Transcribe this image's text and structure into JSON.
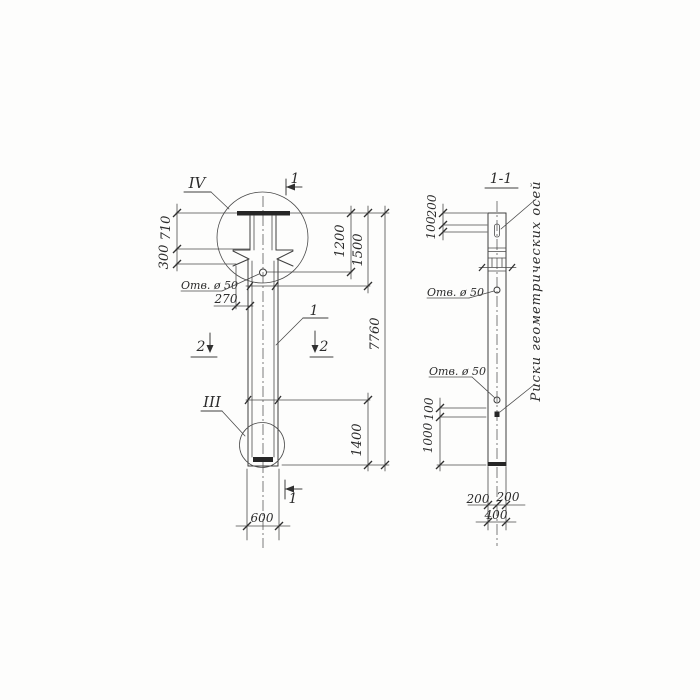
{
  "drawing": {
    "left_view": {
      "detail_circle_top_label": "IV",
      "detail_circle_bottom_label": "III",
      "section_cut_top_label": "1",
      "section_cut_bottom_label": "1",
      "section_cut_left_label": "2",
      "section_cut_right_label": "2",
      "position_label": "1",
      "hole_label": "Отв. ø 50",
      "dim_710": "710",
      "dim_300": "300",
      "dim_270": "270",
      "dim_1200": "1200",
      "dim_1500": "1500",
      "dim_7760": "7760",
      "dim_1400": "1400",
      "dim_600": "600"
    },
    "section_view": {
      "title": "1-1",
      "dim_200_top": "200",
      "dim_100_top": "100",
      "hole_label_upper": "Отв. ø 50",
      "hole_label_lower": "Отв. ø 50",
      "dim_100_mid": "100",
      "dim_1000": "1000",
      "dim_200_bottom_left": "200",
      "dim_200_bottom_right": "200",
      "dim_400": "400",
      "axes_note": "Риски геометрических осей"
    },
    "line_color": "#3e3e3e",
    "paper_color": "#fdfdfc"
  }
}
